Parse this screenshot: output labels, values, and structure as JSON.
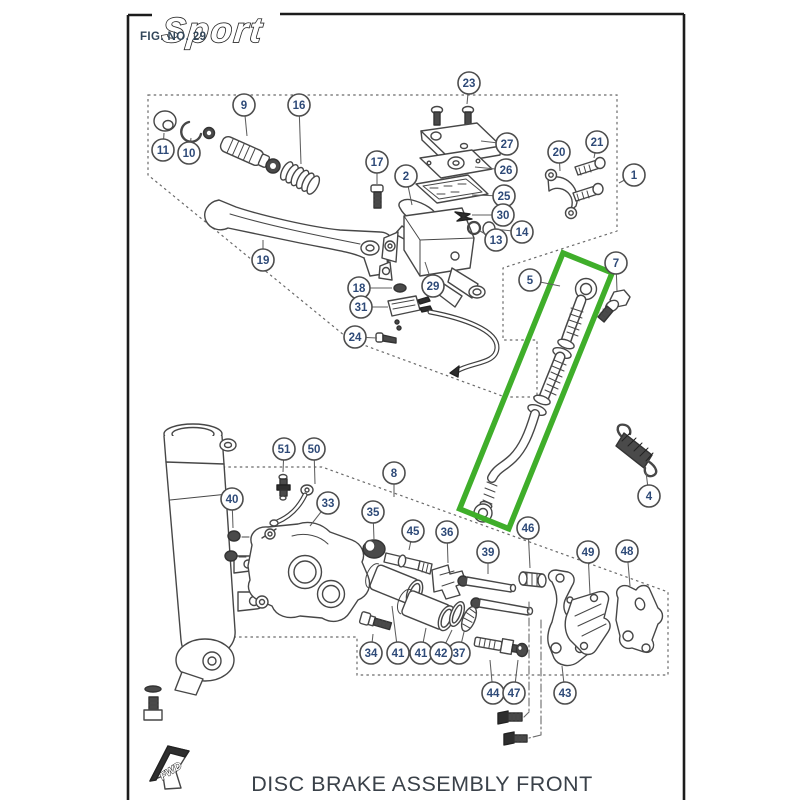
{
  "page": {
    "logo": "Sport",
    "fig_label": "FIG. NO. 29",
    "title": "DISC BRAKE ASSEMBLY FRONT",
    "fwd_label": "FWD"
  },
  "diagram": {
    "highlight": {
      "highlighted_callout": "5",
      "color": "#3fae2a",
      "x": 563,
      "y": 253,
      "width": 53,
      "height": 276,
      "rotation_deg": 22
    },
    "callout_style": {
      "radius": 11,
      "number_color": "#2e4a78",
      "circle_color": "#4d4d4d"
    },
    "callouts": [
      {
        "n": "1",
        "x": 634,
        "y": 175,
        "lx": 619,
        "ly": 183
      },
      {
        "n": "2",
        "x": 406,
        "y": 176,
        "lx": 412,
        "ly": 205
      },
      {
        "n": "4",
        "x": 649,
        "y": 496,
        "lx": 646,
        "ly": 472
      },
      {
        "n": "5",
        "x": 530,
        "y": 280,
        "lx": 560,
        "ly": 286
      },
      {
        "n": "7",
        "x": 616,
        "y": 263,
        "lx": 617,
        "ly": 291
      },
      {
        "n": "8",
        "x": 394,
        "y": 473,
        "lx": 394,
        "ly": 497
      },
      {
        "n": "9",
        "x": 244,
        "y": 105,
        "lx": 247,
        "ly": 136
      },
      {
        "n": "10",
        "x": 189,
        "y": 153,
        "lx": 191,
        "ly": 138
      },
      {
        "n": "11",
        "x": 163,
        "y": 150,
        "lx": 164,
        "ly": 133
      },
      {
        "n": "13",
        "x": 496,
        "y": 240,
        "lx": 480,
        "ly": 231
      },
      {
        "n": "14",
        "x": 522,
        "y": 232,
        "lx": 494,
        "ly": 229
      },
      {
        "n": "16",
        "x": 299,
        "y": 105,
        "lx": 301,
        "ly": 164
      },
      {
        "n": "17",
        "x": 377,
        "y": 162,
        "lx": 377,
        "ly": 184
      },
      {
        "n": "18",
        "x": 359,
        "y": 288,
        "lx": 392,
        "ly": 288
      },
      {
        "n": "19",
        "x": 263,
        "y": 260,
        "lx": 263,
        "ly": 240
      },
      {
        "n": "20",
        "x": 559,
        "y": 152,
        "lx": 560,
        "ly": 171
      },
      {
        "n": "21",
        "x": 597,
        "y": 142,
        "lx": 594,
        "ly": 158
      },
      {
        "n": "23",
        "x": 469,
        "y": 83,
        "lx": 467,
        "ly": 104
      },
      {
        "n": "24",
        "x": 355,
        "y": 337,
        "lx": 377,
        "ly": 338
      },
      {
        "n": "25",
        "x": 504,
        "y": 196,
        "lx": 472,
        "ly": 195
      },
      {
        "n": "26",
        "x": 506,
        "y": 170,
        "lx": 475,
        "ly": 167
      },
      {
        "n": "27",
        "x": 507,
        "y": 144,
        "lx": 481,
        "ly": 141
      },
      {
        "n": "29",
        "x": 433,
        "y": 286,
        "lx": 425,
        "ly": 262
      },
      {
        "n": "30",
        "x": 503,
        "y": 215,
        "lx": 472,
        "ly": 215
      },
      {
        "n": "31",
        "x": 361,
        "y": 307,
        "lx": 388,
        "ly": 307
      },
      {
        "n": "33",
        "x": 328,
        "y": 503,
        "lx": 310,
        "ly": 526
      },
      {
        "n": "34",
        "x": 371,
        "y": 653,
        "lx": 373,
        "ly": 634
      },
      {
        "n": "35",
        "x": 373,
        "y": 512,
        "lx": 374,
        "ly": 540
      },
      {
        "n": "36",
        "x": 447,
        "y": 532,
        "lx": 448,
        "ly": 563
      },
      {
        "n": "37",
        "x": 459,
        "y": 653,
        "lx": 464,
        "ly": 632
      },
      {
        "n": "39",
        "x": 488,
        "y": 552,
        "lx": 488,
        "ly": 574
      },
      {
        "n": "40",
        "x": 232,
        "y": 499,
        "lx": 233,
        "ly": 528
      },
      {
        "n": "41",
        "x": 398,
        "y": 653,
        "lx": 392,
        "ly": 606
      },
      {
        "n": "41",
        "x": 421,
        "y": 653,
        "lx": 426,
        "ly": 628
      },
      {
        "n": "42",
        "x": 441,
        "y": 653,
        "lx": 452,
        "ly": 630
      },
      {
        "n": "43",
        "x": 565,
        "y": 693,
        "lx": 562,
        "ly": 666
      },
      {
        "n": "44",
        "x": 493,
        "y": 693,
        "lx": 490,
        "ly": 660
      },
      {
        "n": "45",
        "x": 413,
        "y": 531,
        "lx": 409,
        "ly": 550
      },
      {
        "n": "46",
        "x": 528,
        "y": 528,
        "lx": 530,
        "ly": 568
      },
      {
        "n": "47",
        "x": 514,
        "y": 693,
        "lx": 518,
        "ly": 660
      },
      {
        "n": "48",
        "x": 627,
        "y": 551,
        "lx": 630,
        "ly": 586
      },
      {
        "n": "49",
        "x": 588,
        "y": 552,
        "lx": 590,
        "ly": 594
      },
      {
        "n": "50",
        "x": 314,
        "y": 449,
        "lx": 315,
        "ly": 484
      },
      {
        "n": "51",
        "x": 284,
        "y": 449,
        "lx": 283,
        "ly": 472
      }
    ]
  }
}
